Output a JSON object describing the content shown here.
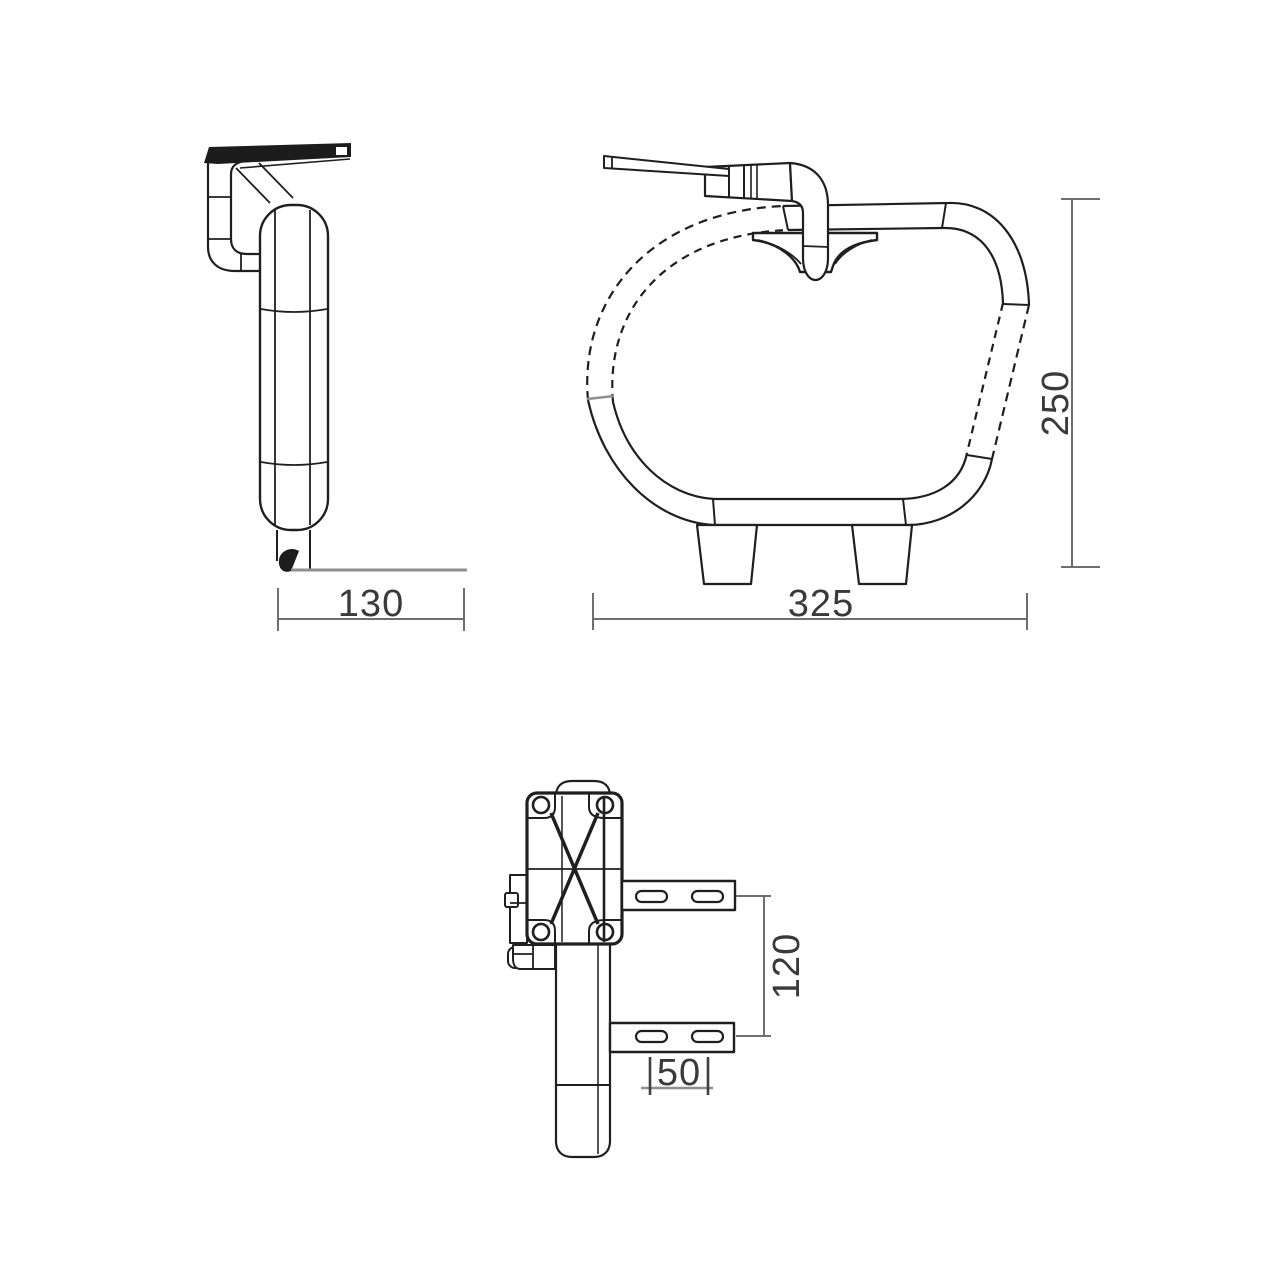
{
  "drawing": {
    "background": "#ffffff",
    "line_color": "#1f1f1f",
    "dim_line_color": "#6e6e6e",
    "dim_text_color": "#3a3a3a",
    "reference_line_color": "#8f8f8f",
    "views": {
      "side_view": {
        "depth_mm": "130"
      },
      "front_view": {
        "width_mm": "325",
        "height_mm": "250"
      },
      "bracket_view": {
        "hole_spacing_vertical_mm": "120",
        "hole_spacing_horizontal_mm": "50"
      }
    }
  }
}
